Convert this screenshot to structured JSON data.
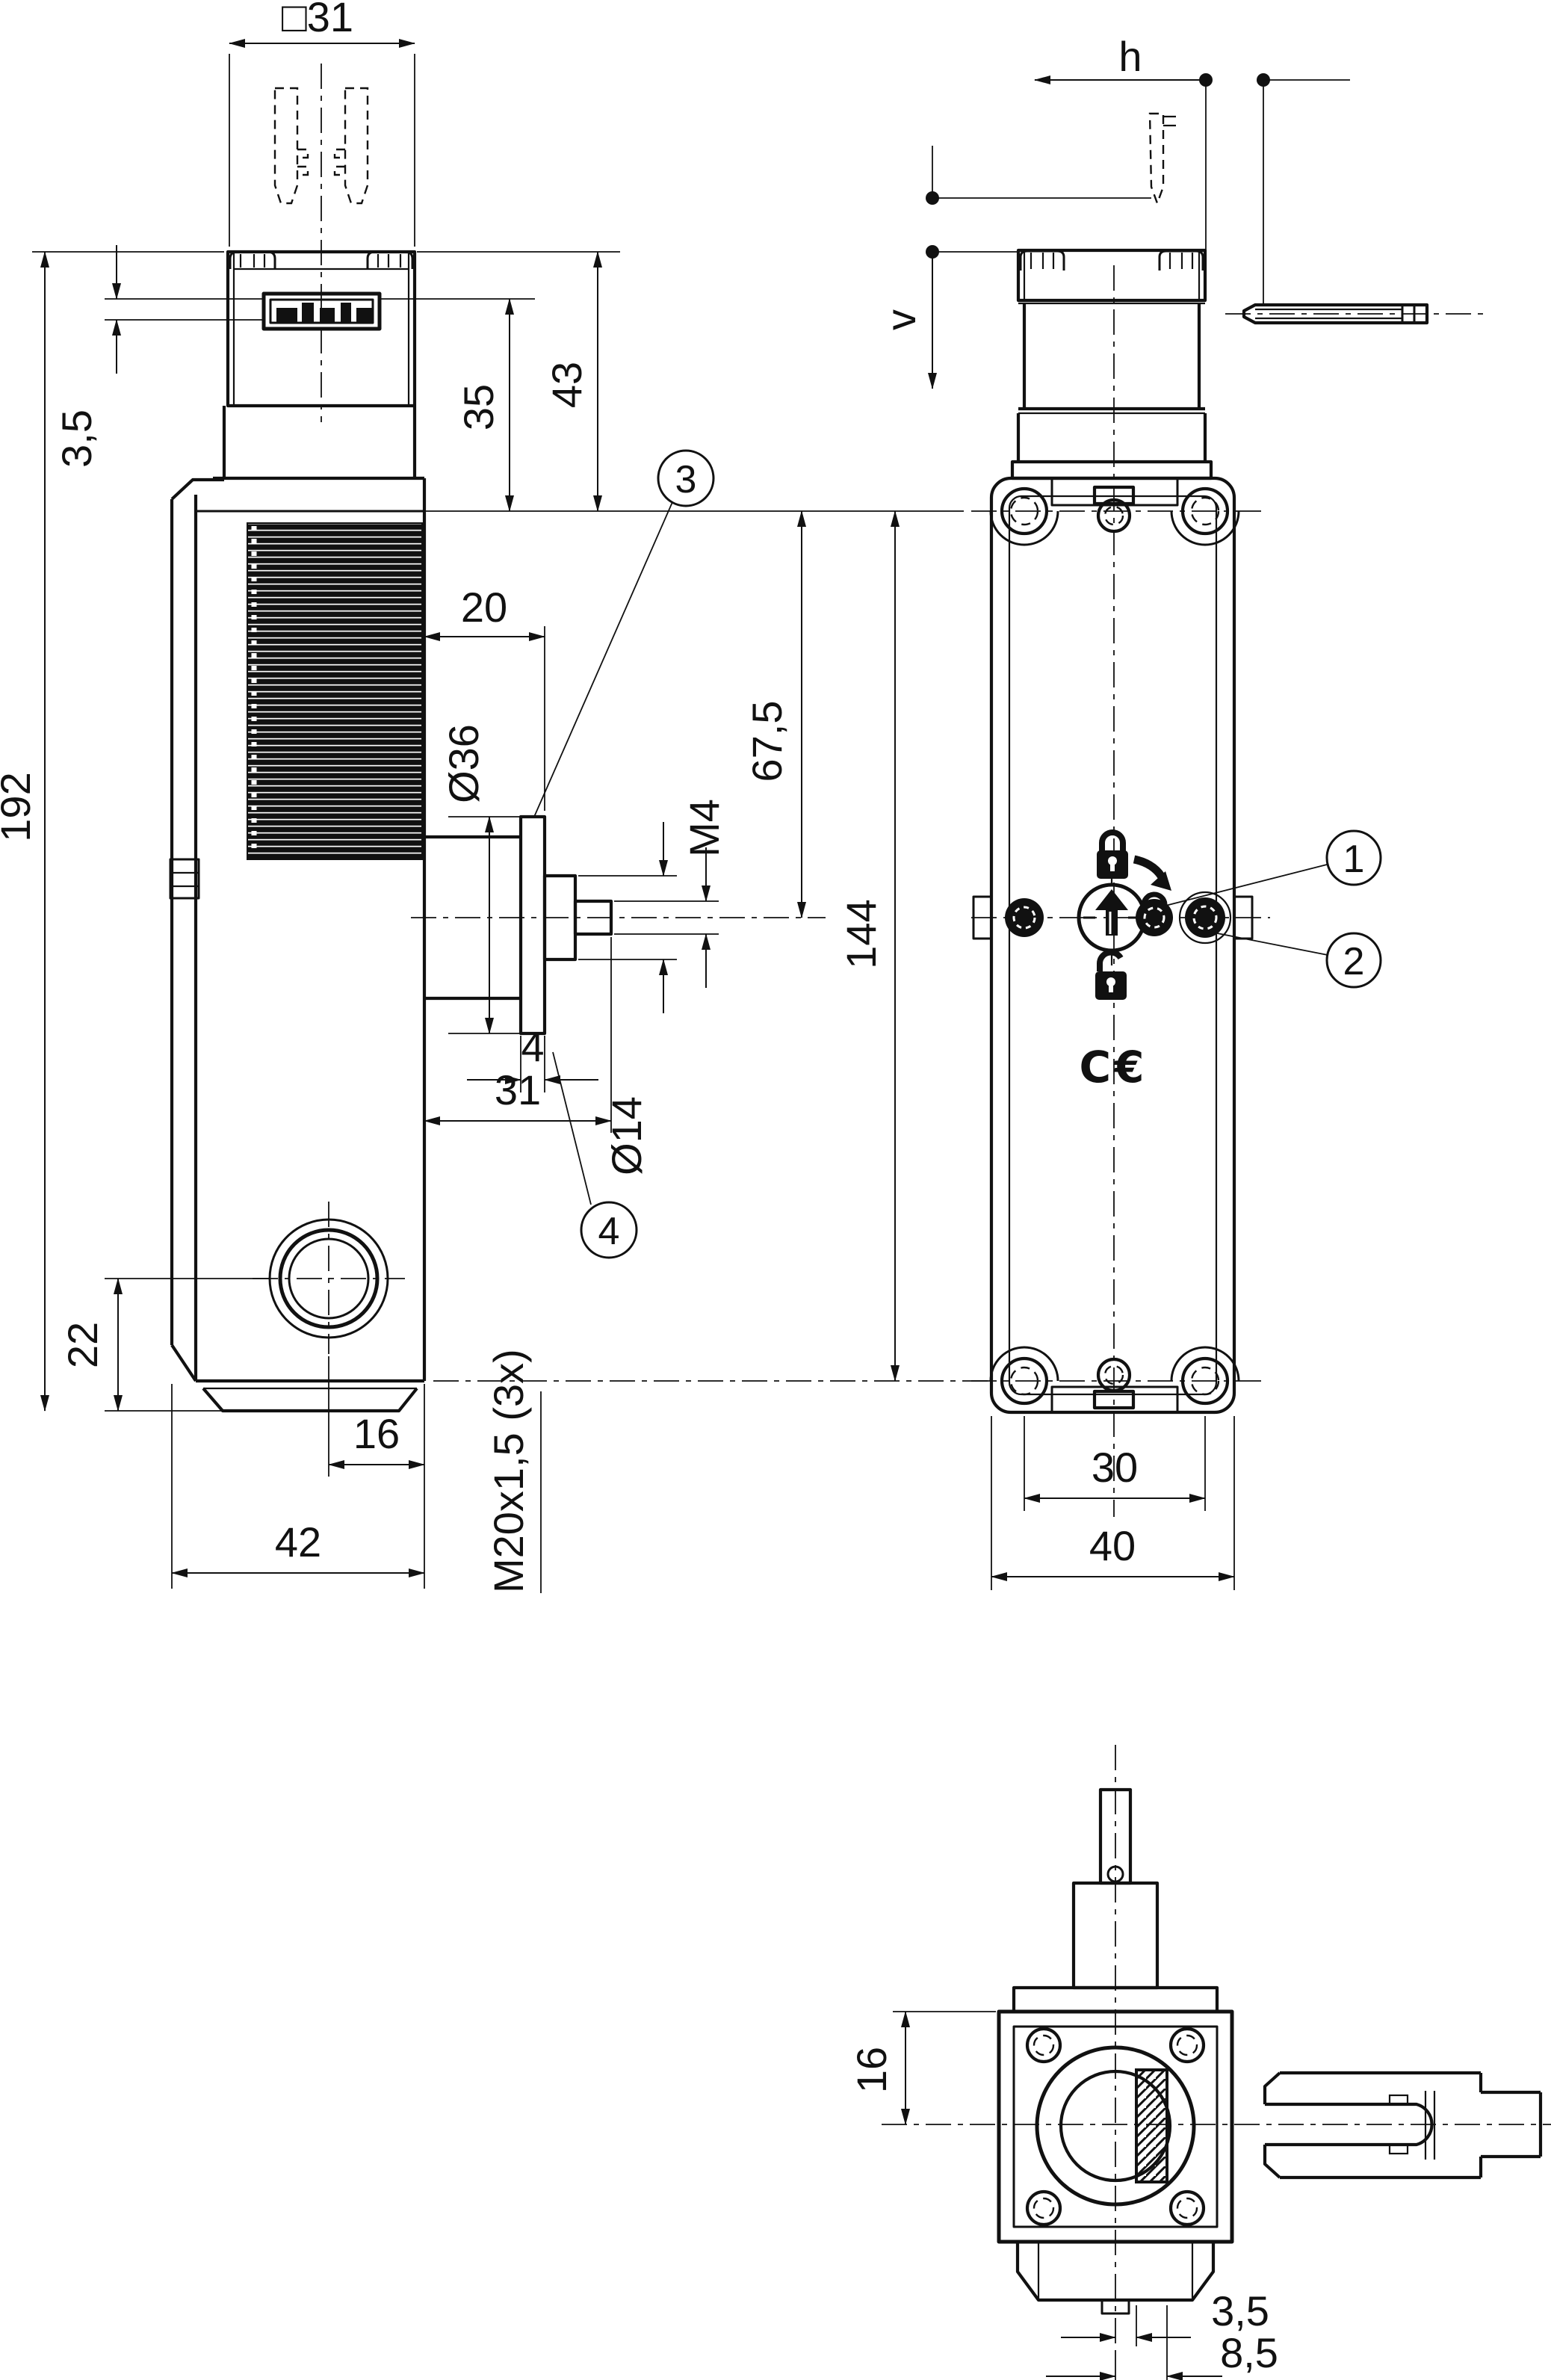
{
  "page": {
    "background": "#ffffff",
    "line_color": "#111111"
  },
  "views": {
    "front": {
      "title": "front-view-with-actuator",
      "dimensions": {
        "head_width": "□31",
        "cover_offset": "3,5",
        "head_window_height": "35",
        "head_height": "43",
        "total_height": "192",
        "handle_length": "20",
        "handle_flange_dia": "Ø36",
        "handle_thread": "M4",
        "axis_from_top": "67,5",
        "body_height": "144",
        "flange_thickness": "4",
        "shaft_length": "31",
        "shaft_dia": "Ø14",
        "gland_height_offset": "22",
        "gland_side_offset": "16",
        "body_width": "42",
        "gland_thread": "M20x1,5 (3x)"
      }
    },
    "side": {
      "title": "side-view",
      "labels": {
        "horizontal_approach": "h",
        "vertical_approach": "v"
      },
      "dimensions": {
        "screw_spacing": "30",
        "body_depth": "40"
      },
      "ce_mark": "C€"
    },
    "top": {
      "title": "top-view-with-actuator",
      "dimensions": {
        "edge_to_axis": "16",
        "slot_near": "3,5",
        "slot_far": "8,5"
      }
    }
  },
  "callouts": [
    {
      "number": "1"
    },
    {
      "number": "2"
    },
    {
      "number": "3"
    },
    {
      "number": "4"
    }
  ]
}
